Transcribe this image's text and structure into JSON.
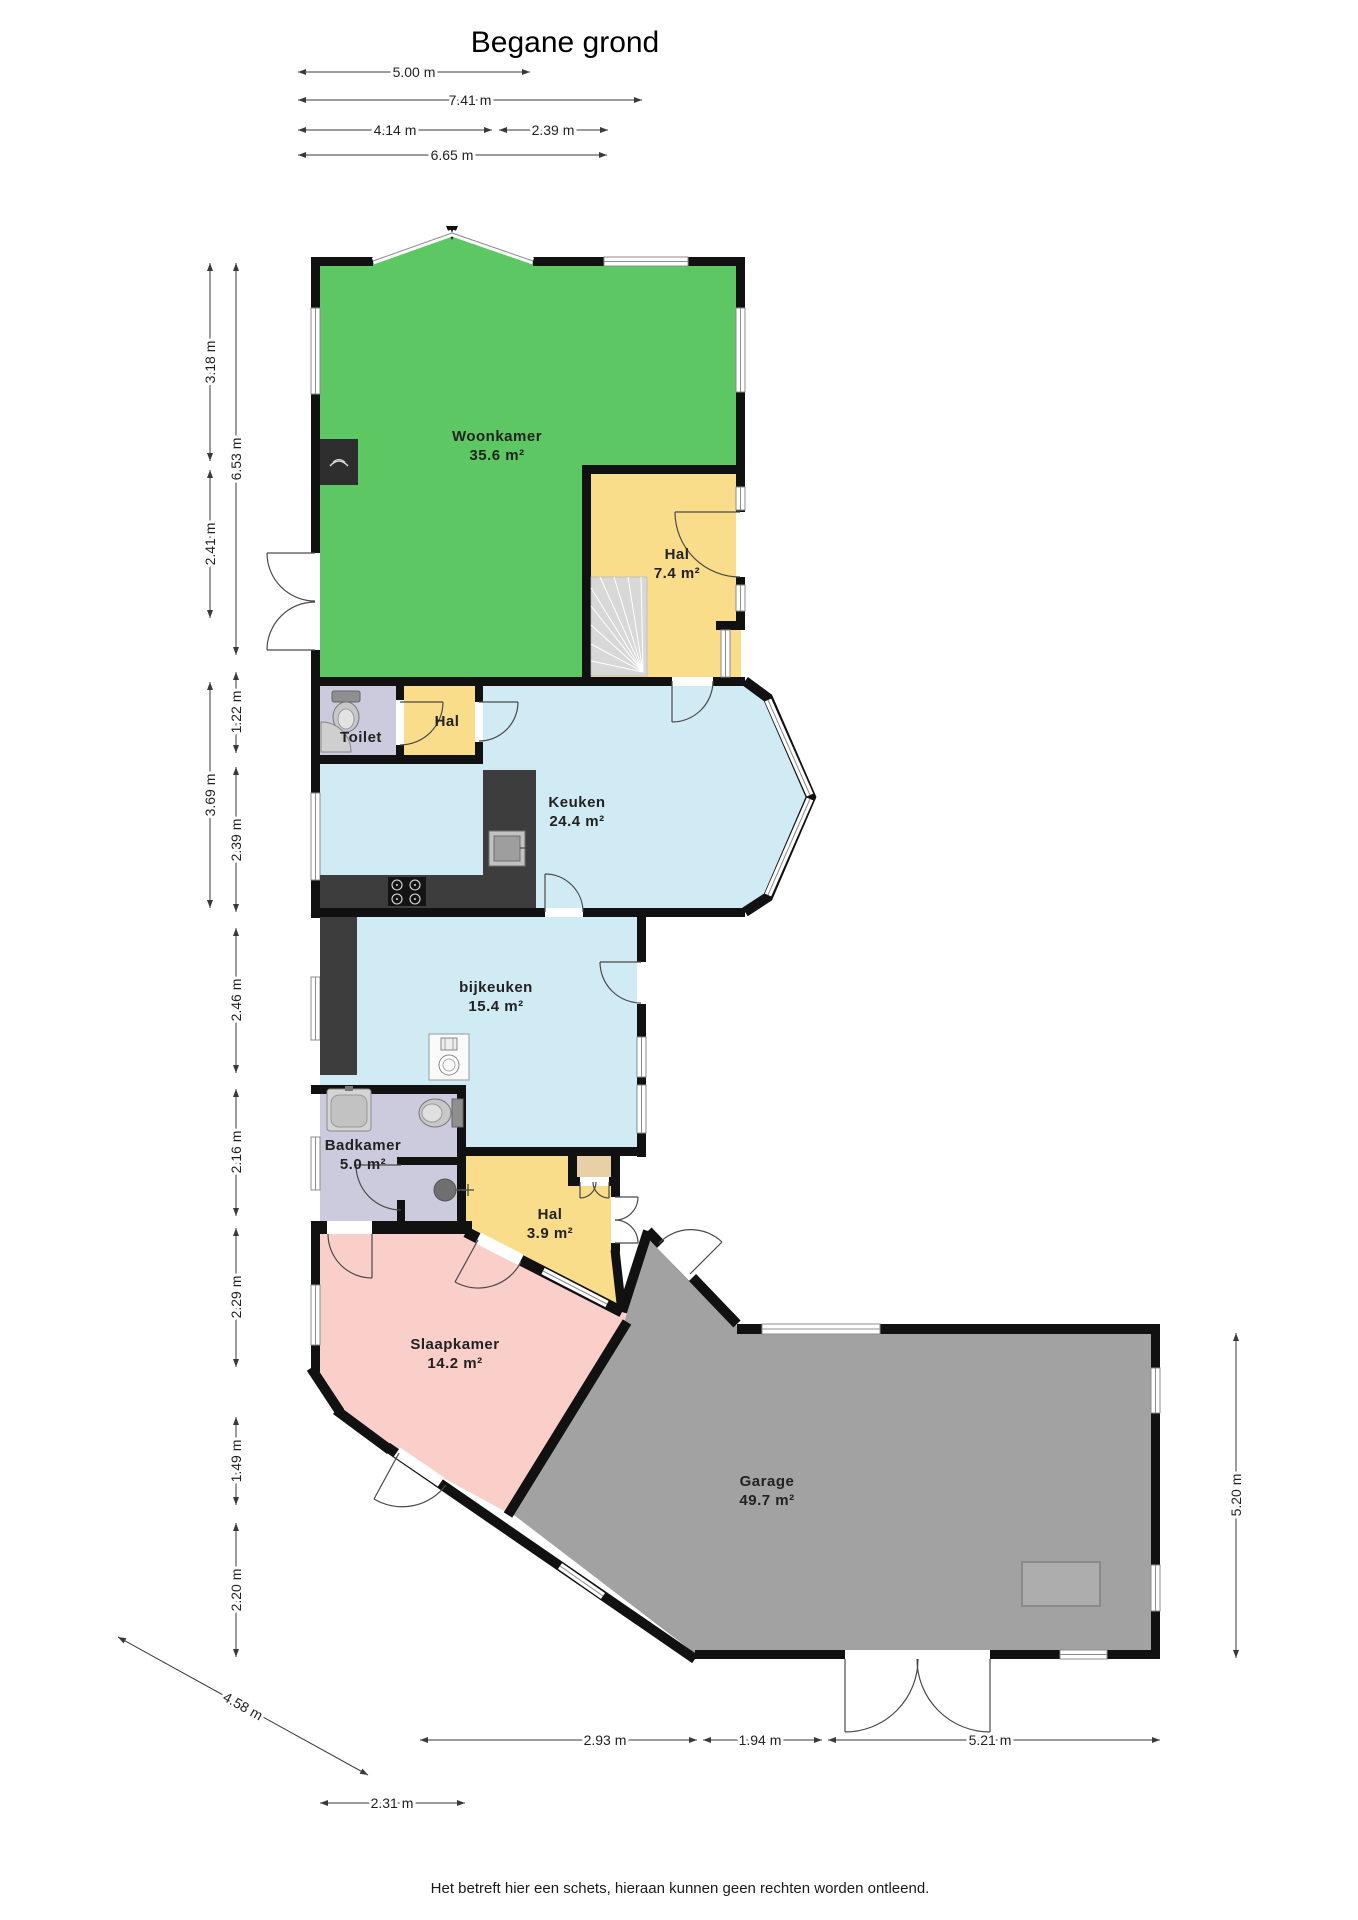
{
  "title": "Begane grond",
  "footer": "Het betreft hier een schets, hieraan kunnen geen rechten worden ontleend.",
  "rooms": {
    "woonkamer": {
      "name": "Woonkamer",
      "area": "35.6 m²"
    },
    "hal_boven": {
      "name": "Hal",
      "area": "7.4 m²"
    },
    "toilet": {
      "name": "Toilet"
    },
    "hal_midden": {
      "name": "Hal"
    },
    "keuken": {
      "name": "Keuken",
      "area": "24.4 m²"
    },
    "bijkeuken": {
      "name": "bijkeuken",
      "area": "15.4 m²"
    },
    "badkamer": {
      "name": "Badkamer",
      "area": "5.0 m²"
    },
    "hal_onder": {
      "name": "Hal",
      "area": "3.9 m²"
    },
    "slaapkamer": {
      "name": "Slaapkamer",
      "area": "14.2 m²"
    },
    "garage": {
      "name": "Garage",
      "area": "49.7 m²"
    }
  },
  "dims": {
    "top_a": "5.00 m",
    "top_b": "7.41 m",
    "top_c": "4.14 m",
    "top_d": "2.39 m",
    "top_e": "6.65 m",
    "left_a": "3.18 m",
    "left_b": "6.53 m",
    "left_c": "2.41 m",
    "left_d": "1.22 m",
    "left_e": "3.69 m",
    "left_f": "2.39 m",
    "left_g": "2.46 m",
    "left_h": "2.16 m",
    "left_i": "2.29 m",
    "left_j": "1.49 m",
    "left_k": "2.20 m",
    "right_a": "5.20 m",
    "bottom_a": "2.93 m",
    "bottom_b": "1.94 m",
    "bottom_c": "5.21 m",
    "bottom_d": "2.31 m",
    "diag_a": "4.58 m"
  },
  "colors": {
    "woonkamer": "#5dc763",
    "hal": "#fadd8a",
    "keuken": "#d0ebf4",
    "sanitair": "#cccbdd",
    "slaapkamer": "#facec9",
    "garage": "#a2a2a2",
    "kast": "#e8cfa5",
    "wall": "#111111",
    "counter": "#3d3d3d",
    "stairs": "#d8d8d8"
  }
}
